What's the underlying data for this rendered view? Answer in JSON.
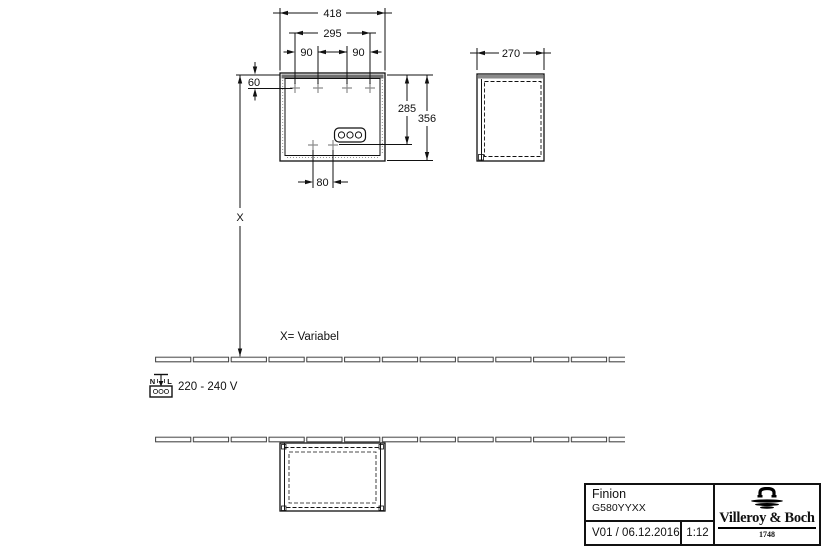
{
  "front_view": {
    "dim_width": "418",
    "dim_inner_width": "295",
    "dim_hole_left": "90",
    "dim_hole_right": "90",
    "dim_top_offset": "60",
    "dim_socket_height": "285",
    "dim_total_height": "356",
    "dim_bottom_holes": "80"
  },
  "side_view": {
    "dim_depth": "270"
  },
  "mounting": {
    "x_label": "X",
    "x_note": "X= Variabel",
    "voltage_label": "220 - 240 V",
    "socket_n": "N",
    "socket_l": "L"
  },
  "title_block": {
    "product_name": "Finion",
    "product_code": "G580YYXX",
    "version_date": "V01 / 06.12.2016",
    "scale": "1:12",
    "brand_name": "Villeroy & Boch",
    "brand_year": "1748"
  },
  "colors": {
    "top_band": "#6f6f6f",
    "side_top_band": "#8a8a8a",
    "cross": "#8c8c8c",
    "line": "#111111"
  }
}
